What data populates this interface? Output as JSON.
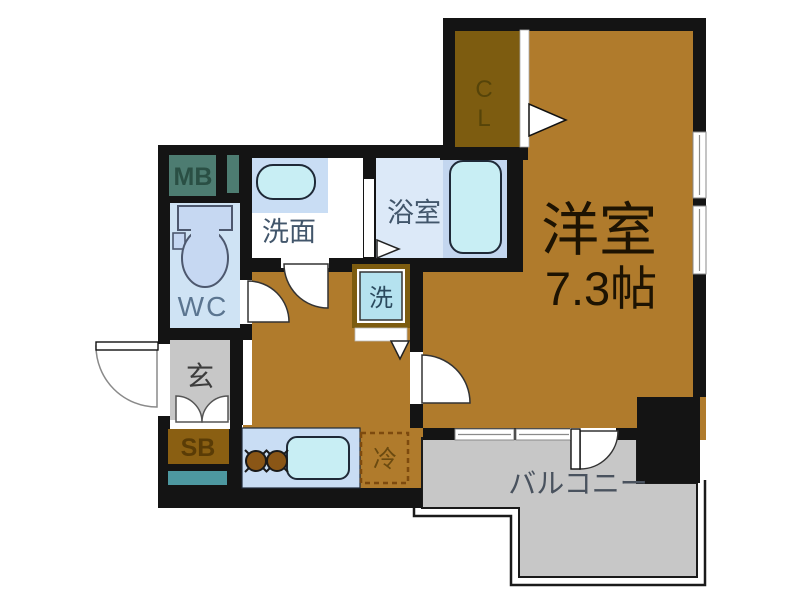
{
  "labels": {
    "western_room": "洋室",
    "western_room_size": "7.3帖",
    "closet_c": "C",
    "closet_l": "L",
    "bathroom": "浴室",
    "washroom": "洗面",
    "toilet": "WC",
    "entrance": "玄",
    "shoe_box": "SB",
    "meter_box": "MB",
    "washing_machine": "洗",
    "refrigerator": "冷",
    "balcony": "バルコニー"
  },
  "colors": {
    "floor_brown": "#b07b2c",
    "closet_brown": "#7d5c10",
    "shoe_box_brown": "#8a5f12",
    "wall_black": "#141414",
    "wc_floor_blue": "#cfe3f4",
    "bath_floor_blue": "#dce9f8",
    "tub_panel_blue": "#c3d6ef",
    "water_cyan": "#c8eef4",
    "counter_blue": "#c9ddf4",
    "washer_blue": "#b5e2ef",
    "gray_area": "#c7c7c7",
    "meter_teal": "#4d7c71",
    "duct_teal": "#4d98a0",
    "burner_brown": "#8a5616"
  }
}
